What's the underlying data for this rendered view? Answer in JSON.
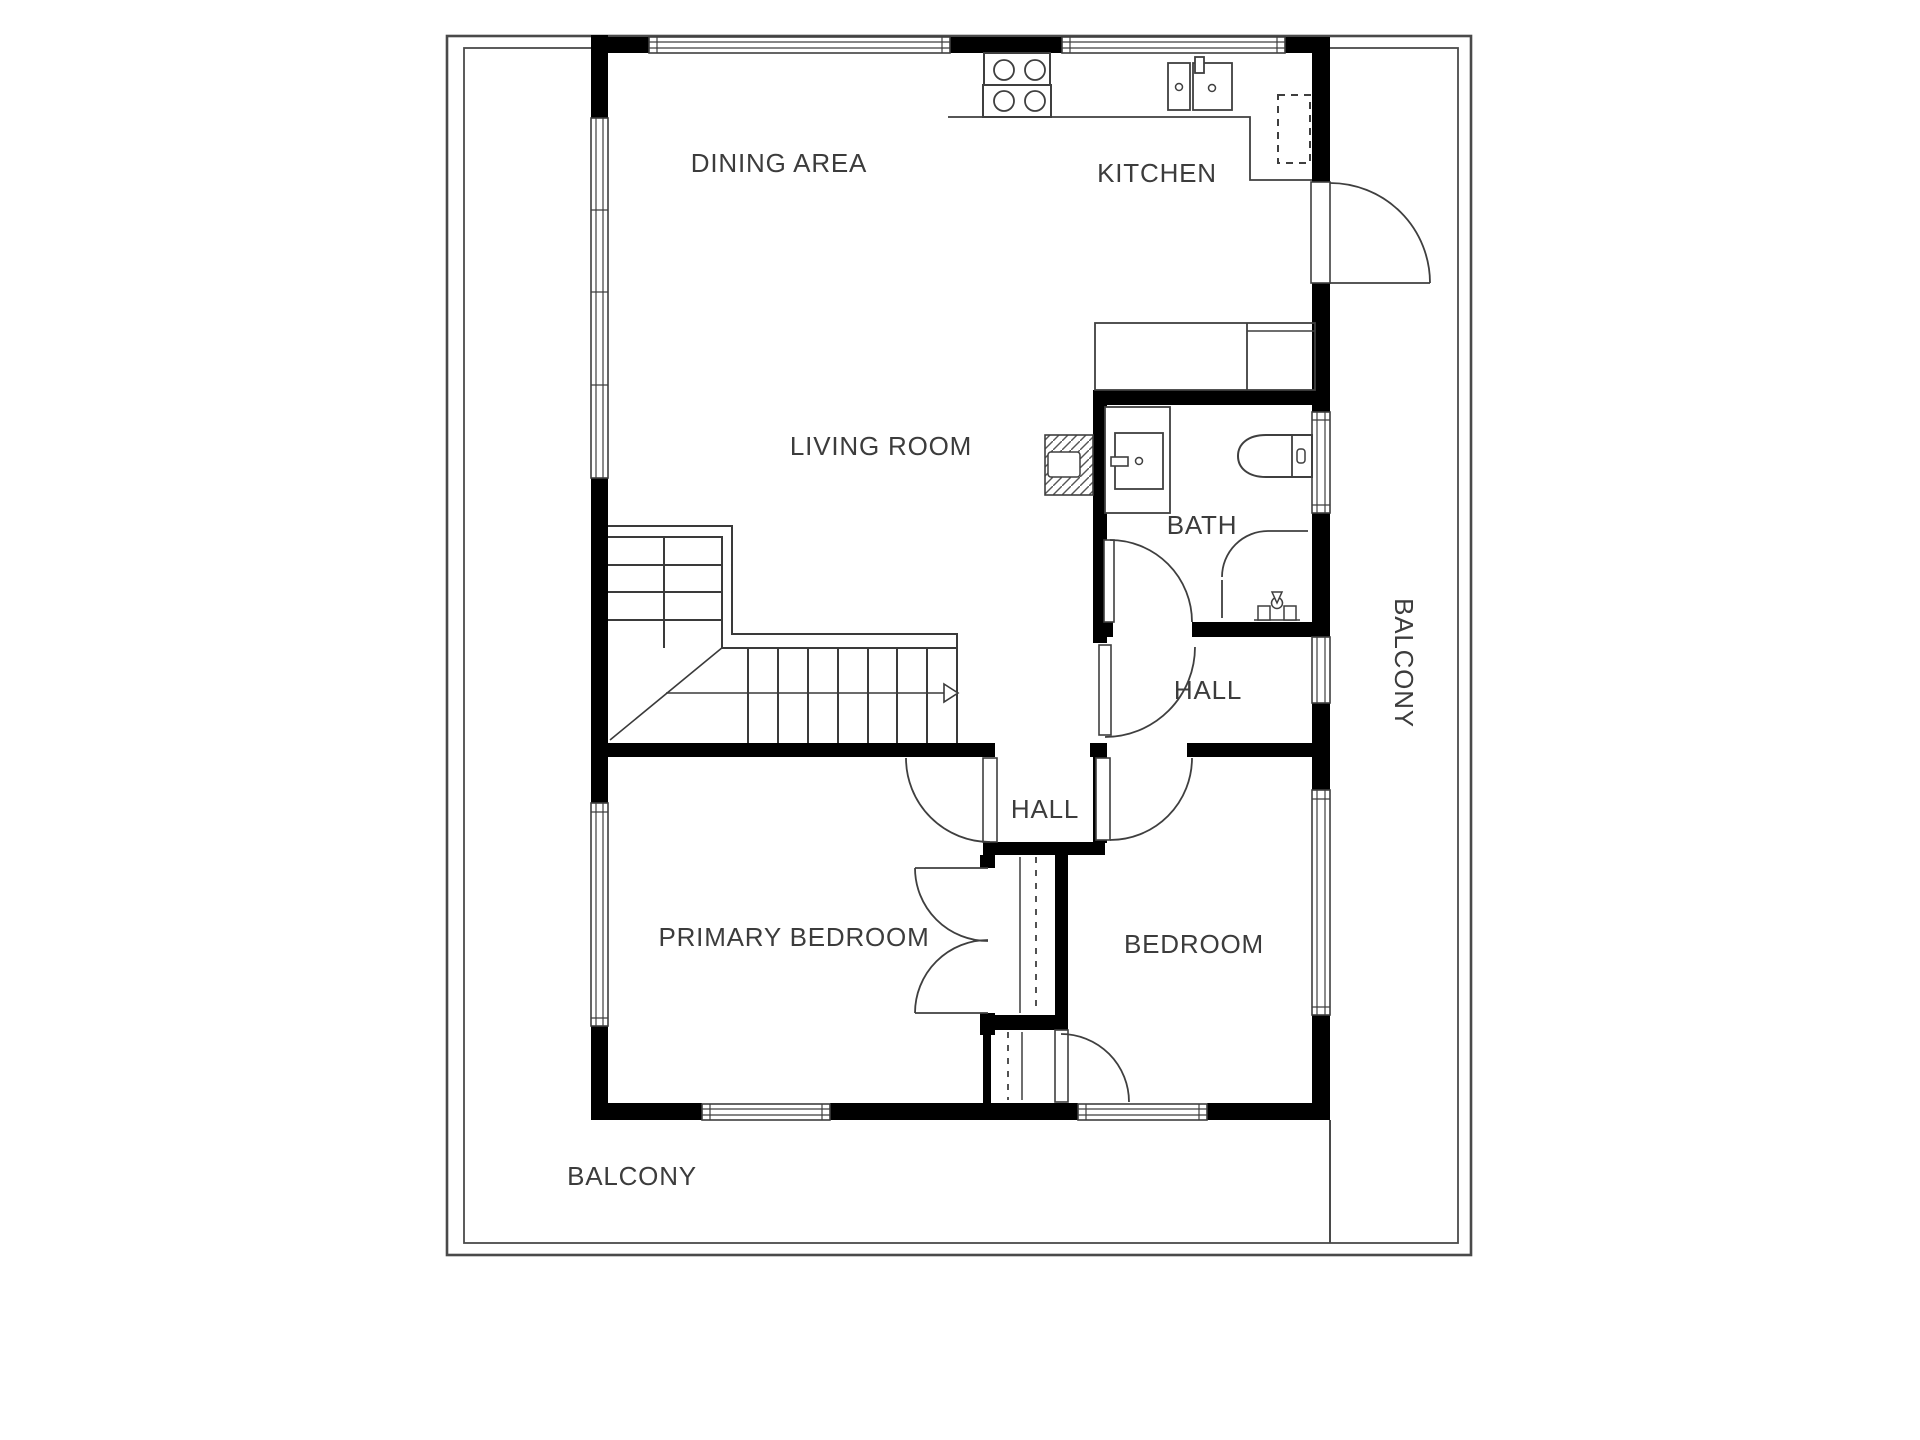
{
  "plan": {
    "title": "Apartment floor plan",
    "rooms": [
      {
        "id": "dining-area",
        "label": "DINING AREA"
      },
      {
        "id": "kitchen",
        "label": "KITCHEN"
      },
      {
        "id": "living-room",
        "label": "LIVING ROOM"
      },
      {
        "id": "bath",
        "label": "BATH"
      },
      {
        "id": "hall-upper",
        "label": "HALL"
      },
      {
        "id": "hall-lower",
        "label": "HALL"
      },
      {
        "id": "primary-bedroom",
        "label": "PRIMARY BEDROOM"
      },
      {
        "id": "bedroom",
        "label": "BEDROOM"
      },
      {
        "id": "balcony-right",
        "label": "BALCONY"
      },
      {
        "id": "balcony-bottom",
        "label": "BALCONY"
      }
    ],
    "colors": {
      "wall": "#000000",
      "line": "#3f3f3f",
      "label": "#3c3c3c",
      "background": "#ffffff"
    }
  }
}
